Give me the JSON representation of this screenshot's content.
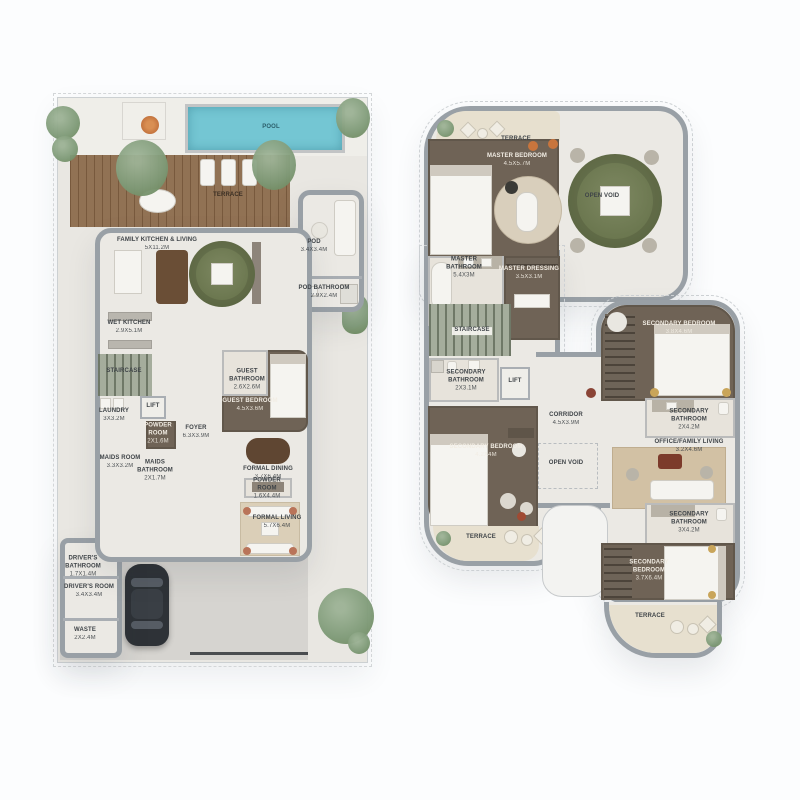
{
  "colors": {
    "pool": "#74c6d3",
    "deck_wood": "#8b6a4b",
    "wall": "#99a0a6",
    "floor_light": "#eae8e2",
    "floor_dark": "#6f6356",
    "terrace_beige": "#e7e0cf",
    "greenery": "#7e9a77",
    "rug_olive": "#6d7a51",
    "rug_beige": "#d2c1a4",
    "accent_rust": "#7c3b2b"
  },
  "ground_floor": {
    "labels": [
      {
        "text": "POOL",
        "dims": "",
        "x": 271,
        "y": 128,
        "w": 40,
        "tone": "pool"
      },
      {
        "text": "TERRACE",
        "dims": "",
        "x": 228,
        "y": 196,
        "w": 60,
        "tone": "deck"
      },
      {
        "text": "FAMILY KITCHEN & LIVING",
        "dims": "5x11.2m",
        "x": 157,
        "y": 245,
        "w": 120
      },
      {
        "text": "POD",
        "dims": "3.4x3.4m",
        "x": 314,
        "y": 247,
        "w": 50
      },
      {
        "text": "POD BATHROOM",
        "dims": "2.9x2.4m",
        "x": 324,
        "y": 293,
        "w": 80
      },
      {
        "text": "WET KITCHEN",
        "dims": "2.9x5.1m",
        "x": 129,
        "y": 328,
        "w": 70
      },
      {
        "text": "STAIRCASE",
        "dims": "",
        "x": 124,
        "y": 372,
        "w": 70
      },
      {
        "text": "GUEST BATHROOM",
        "dims": "2.6x2.6m",
        "x": 247,
        "y": 380,
        "w": 44
      },
      {
        "text": "GUEST BEDROOM",
        "dims": "4.5x3.6m",
        "x": 250,
        "y": 406,
        "w": 95,
        "tone": "ld"
      },
      {
        "text": "LAUNDRY",
        "dims": "3x3.2m",
        "x": 114,
        "y": 416,
        "w": 56
      },
      {
        "text": "LIFT",
        "dims": "",
        "x": 153,
        "y": 407,
        "w": 40
      },
      {
        "text": "POWDER ROOM",
        "dims": "2x1.6m",
        "x": 158,
        "y": 434,
        "w": 42,
        "tone": "ld"
      },
      {
        "text": "FOYER",
        "dims": "6.3x3.9m",
        "x": 196,
        "y": 433,
        "w": 56
      },
      {
        "text": "MAIDS ROOM",
        "dims": "3.3x3.2m",
        "x": 120,
        "y": 463,
        "w": 66
      },
      {
        "text": "MAIDS BATHROOM",
        "dims": "2x1.7m",
        "x": 155,
        "y": 471,
        "w": 48
      },
      {
        "text": "FORMAL DINING",
        "dims": "3.7x6.4m",
        "x": 268,
        "y": 474,
        "w": 80
      },
      {
        "text": "POWDER ROOM",
        "dims": "1.6x4.4m",
        "x": 267,
        "y": 489,
        "w": 42
      },
      {
        "text": "FORMAL LIVING",
        "dims": "5.7x6.4m",
        "x": 277,
        "y": 523,
        "w": 80
      },
      {
        "text": "DRIVER'S BATHROOM",
        "dims": "1.7x1.4m",
        "x": 83,
        "y": 567,
        "w": 50
      },
      {
        "text": "DRIVER'S ROOM",
        "dims": "3.4x3.4m",
        "x": 89,
        "y": 592,
        "w": 80
      },
      {
        "text": "WASTE",
        "dims": "2x2.4m",
        "x": 85,
        "y": 635,
        "w": 50
      }
    ]
  },
  "first_floor": {
    "labels": [
      {
        "text": "TERRACE",
        "dims": "",
        "x": 516,
        "y": 140,
        "w": 60
      },
      {
        "text": "MASTER BEDROOM",
        "dims": "4.5x5.7m",
        "x": 517,
        "y": 161,
        "w": 95,
        "tone": "ld"
      },
      {
        "text": "OPEN VOID",
        "dims": "",
        "x": 602,
        "y": 197,
        "w": 70
      },
      {
        "text": "MASTER BATHROOM",
        "dims": "5.4x3m",
        "x": 464,
        "y": 268,
        "w": 52
      },
      {
        "text": "MASTER DRESSING",
        "dims": "3.5x3.1m",
        "x": 529,
        "y": 274,
        "w": 92,
        "tone": "ld"
      },
      {
        "text": "STAIRCASE",
        "dims": "",
        "x": 472,
        "y": 331,
        "w": 70,
        "tag": true
      },
      {
        "text": "SECONDARY BATHROOM",
        "dims": "2x3.1m",
        "x": 466,
        "y": 381,
        "w": 58
      },
      {
        "text": "LIFT",
        "dims": "",
        "x": 515,
        "y": 382,
        "w": 40
      },
      {
        "text": "CORRIDOR",
        "dims": "4.5x3.9m",
        "x": 566,
        "y": 420,
        "w": 60
      },
      {
        "text": "SECONDARY BEDROOM",
        "dims": "4.2x4m",
        "x": 486,
        "y": 452,
        "w": 105,
        "tone": "ld"
      },
      {
        "text": "OPEN VOID",
        "dims": "",
        "x": 566,
        "y": 464,
        "w": 70
      },
      {
        "text": "TERRACE",
        "dims": "",
        "x": 481,
        "y": 538,
        "w": 60
      },
      {
        "text": "SECONDARY BEDROOM",
        "dims": "3.8x4.6m",
        "x": 679,
        "y": 329,
        "w": 105,
        "tone": "ld"
      },
      {
        "text": "SECONDARY BATHROOM",
        "dims": "2x4.2m",
        "x": 689,
        "y": 420,
        "w": 58
      },
      {
        "text": "OFFICE/FAMILY LIVING",
        "dims": "3.2x4.6m",
        "x": 689,
        "y": 447,
        "w": 100
      },
      {
        "text": "SECONDARY BATHROOM",
        "dims": "3x4.2m",
        "x": 689,
        "y": 523,
        "w": 58
      },
      {
        "text": "SECONDARY BEDROOM",
        "dims": "3.7x6.4m",
        "x": 649,
        "y": 571,
        "w": 54,
        "tone": "ld"
      },
      {
        "text": "TERRACE",
        "dims": "",
        "x": 650,
        "y": 617,
        "w": 60
      }
    ]
  }
}
